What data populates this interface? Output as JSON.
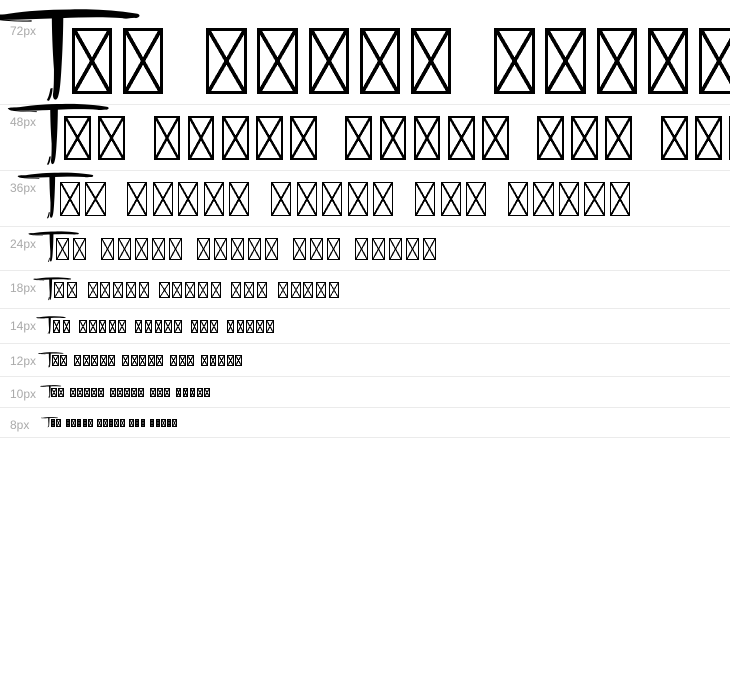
{
  "page": {
    "background_color": "#ffffff"
  },
  "waterfall": {
    "sample_text": "The quick brown fox jumps",
    "rows": [
      {
        "label": "72px",
        "px": 72
      },
      {
        "label": "48px",
        "px": 48
      },
      {
        "label": "36px",
        "px": 36
      },
      {
        "label": "24px",
        "px": 24
      },
      {
        "label": "18px",
        "px": 18
      },
      {
        "label": "14px",
        "px": 14
      },
      {
        "label": "12px",
        "px": 12
      },
      {
        "label": "10px",
        "px": 10
      },
      {
        "label": "8px",
        "px": 8
      }
    ],
    "label_color": "#aaaaaa",
    "divider_color": "#ebebeb",
    "glyph_color": "#000000",
    "glyphs": {
      "T": "brush-stroke-T-glyph",
      "other_letters": "notdef-box-with-x-glyph"
    }
  }
}
